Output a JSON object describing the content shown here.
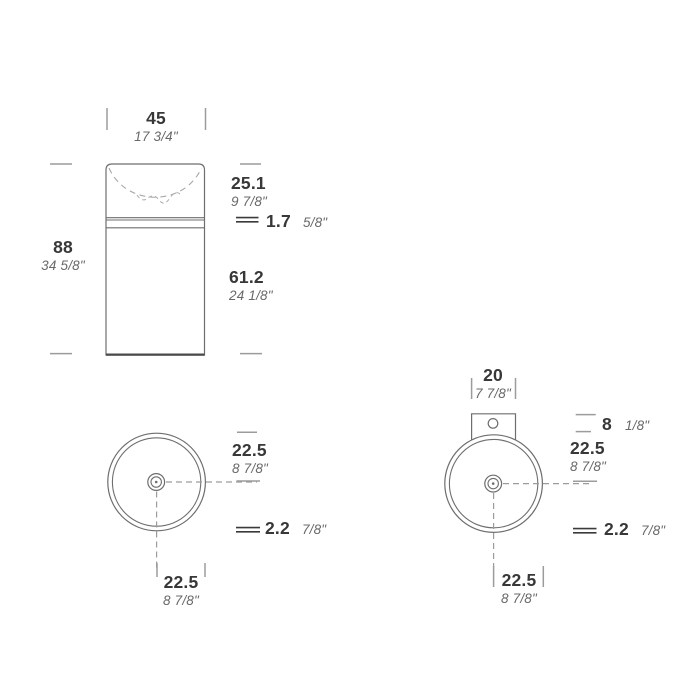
{
  "drawing": {
    "title": "washbasin-dimension-drawing",
    "front_view": {
      "width": {
        "metric": "45",
        "imperial": "17 3/4\""
      },
      "height": {
        "metric": "88",
        "imperial": "34 5/8\""
      },
      "basin_depth": {
        "metric": "25.1",
        "imperial": "9 7/8\""
      },
      "rim_thickness": {
        "metric": "1.7",
        "imperial": "5/8\""
      },
      "body_height": {
        "metric": "61.2",
        "imperial": "24 1/8\""
      }
    },
    "top_view_left": {
      "radius_horizontal": {
        "metric": "22.5",
        "imperial": "8 7/8\""
      },
      "wall_thickness": {
        "metric": "2.2",
        "imperial": "7/8\""
      },
      "radius_vertical": {
        "metric": "22.5",
        "imperial": "8 7/8\""
      }
    },
    "top_view_right": {
      "tap_plate_width": {
        "metric": "20",
        "imperial": "7 7/8\""
      },
      "tap_plate_offset": {
        "metric": "8",
        "imperial": "1/8\""
      },
      "radius_horizontal": {
        "metric": "22.5",
        "imperial": "8 7/8\""
      },
      "wall_thickness": {
        "metric": "2.2",
        "imperial": "7/8\""
      },
      "radius_vertical": {
        "metric": "22.5",
        "imperial": "8 7/8\""
      }
    },
    "colors": {
      "outline": "#6e6e6e",
      "tick": "#9c9c9c",
      "dashed_centerline": "#9c9c9c",
      "metric_text": "#383838",
      "imperial_text": "#696969",
      "background": "#ffffff"
    }
  }
}
